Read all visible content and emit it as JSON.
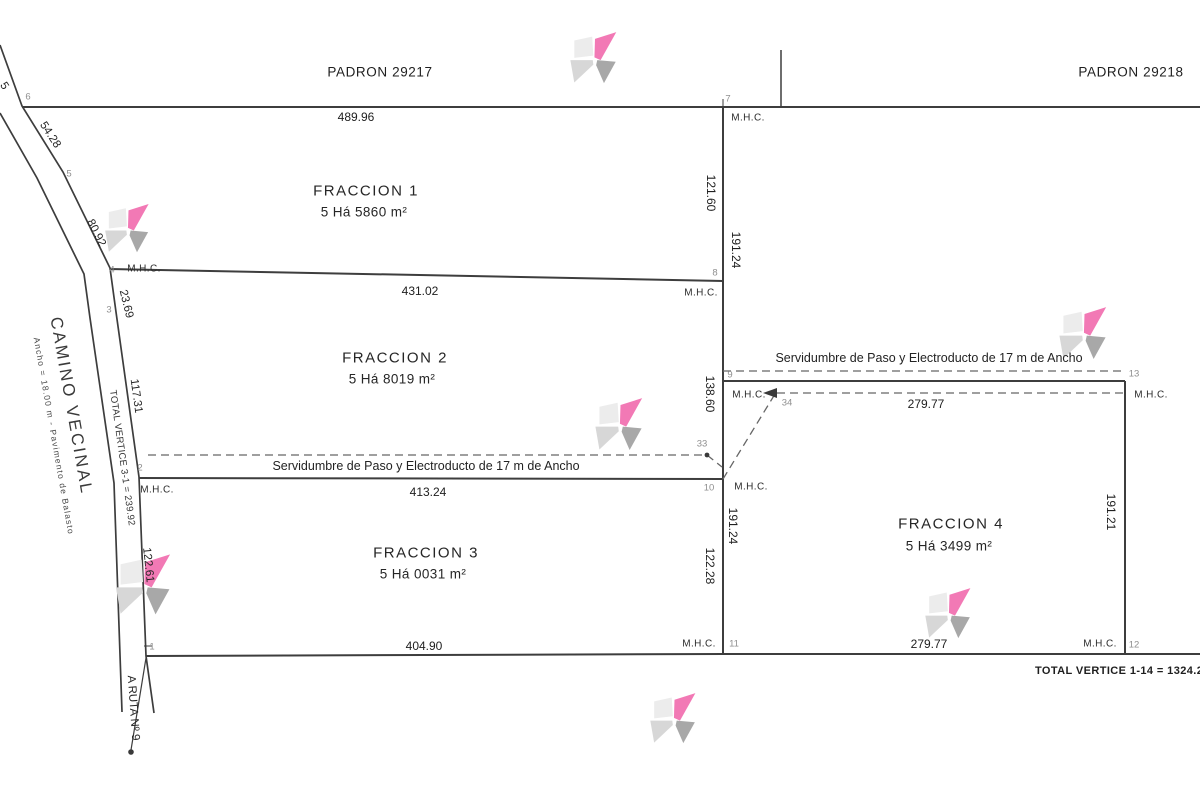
{
  "canvas": {
    "width": 1200,
    "height": 790,
    "background": "#ffffff"
  },
  "colors": {
    "line": "#3d3d3d",
    "dashed_line": "#666666",
    "text": "#232323",
    "vertex_text": "#8f8f8f"
  },
  "watermark_colors": {
    "pink": "#f279b5",
    "gray_light": "#ececec",
    "gray_mid": "#d7d7d7",
    "gray_dark": "#a8a8a8"
  },
  "watermarks": [
    {
      "x": 567,
      "y": 31,
      "size": 56
    },
    {
      "x": 102,
      "y": 203,
      "size": 53
    },
    {
      "x": 1056,
      "y": 306,
      "size": 57
    },
    {
      "x": 592,
      "y": 397,
      "size": 57
    },
    {
      "x": 112,
      "y": 553,
      "size": 66
    },
    {
      "x": 922,
      "y": 587,
      "size": 55
    },
    {
      "x": 647,
      "y": 692,
      "size": 55
    }
  ],
  "labels": [
    {
      "id": "padron-left-label",
      "text": "PADRON 29217",
      "x": 380,
      "y": 72,
      "cls": "padron"
    },
    {
      "id": "padron-right-label",
      "text": "PADRON 29218",
      "x": 1131,
      "y": 72,
      "cls": "padron"
    },
    {
      "id": "dim-6-7",
      "text": "489.96",
      "x": 356,
      "y": 117,
      "cls": "dim"
    },
    {
      "id": "vertex-7",
      "text": "7",
      "x": 728,
      "y": 99,
      "cls": "vertex"
    },
    {
      "id": "mhc-v7",
      "text": "M.H.C.",
      "x": 748,
      "y": 118,
      "cls": "mhc"
    },
    {
      "id": "dim-121-60",
      "text": "121.60",
      "x": 711,
      "y": 193,
      "rot": 90,
      "cls": "dim"
    },
    {
      "id": "dim-191-24-top",
      "text": "191.24",
      "x": 736,
      "y": 250,
      "rot": 90,
      "cls": "dim"
    },
    {
      "id": "fraccion1-name",
      "text": "FRACCION 1",
      "x": 366,
      "y": 191,
      "cls": "frac"
    },
    {
      "id": "fraccion1-area",
      "text": "5 Há 5860 m²",
      "x": 364,
      "y": 212,
      "cls": "area"
    },
    {
      "id": "vertex-4",
      "text": "4",
      "x": 112,
      "y": 270,
      "cls": "vertex"
    },
    {
      "id": "mhc-v4",
      "text": "M.H.C.",
      "x": 144,
      "y": 269,
      "cls": "mhc"
    },
    {
      "id": "vertex-8",
      "text": "8",
      "x": 715,
      "y": 273,
      "cls": "vertex"
    },
    {
      "id": "dim-4-8",
      "text": "431.02",
      "x": 420,
      "y": 291,
      "cls": "dim"
    },
    {
      "id": "mhc-v8",
      "text": "M.H.C.",
      "x": 701,
      "y": 293,
      "cls": "mhc"
    },
    {
      "id": "fraccion2-name",
      "text": "FRACCION 2",
      "x": 395,
      "y": 358,
      "cls": "frac"
    },
    {
      "id": "fraccion2-area",
      "text": "5 Há 8019 m²",
      "x": 392,
      "y": 379,
      "cls": "area"
    },
    {
      "id": "servidumbre-right",
      "text": "Servidumbre de Paso y Electroducto de 17 m de Ancho",
      "x": 929,
      "y": 358,
      "cls": "serv"
    },
    {
      "id": "dim-138-60",
      "text": "138.60",
      "x": 710,
      "y": 394,
      "rot": 90,
      "cls": "dim"
    },
    {
      "id": "vertex-9",
      "text": "9",
      "x": 730,
      "y": 375,
      "cls": "vertex"
    },
    {
      "id": "mhc-v9",
      "text": "M.H.C.",
      "x": 749,
      "y": 395,
      "cls": "mhc"
    },
    {
      "id": "vertex-34",
      "text": "34",
      "x": 787,
      "y": 403,
      "cls": "vertex"
    },
    {
      "id": "dim-34-13",
      "text": "279.77",
      "x": 926,
      "y": 404,
      "cls": "dim"
    },
    {
      "id": "vertex-13",
      "text": "13",
      "x": 1134,
      "y": 374,
      "cls": "vertex"
    },
    {
      "id": "mhc-v13",
      "text": "M.H.C.",
      "x": 1151,
      "y": 395,
      "cls": "mhc"
    },
    {
      "id": "vertex-33",
      "text": "33",
      "x": 702,
      "y": 444,
      "cls": "vertex"
    },
    {
      "id": "servidumbre-left",
      "text": "Servidumbre de Paso y Electroducto de 17 m de Ancho",
      "x": 426,
      "y": 466,
      "cls": "serv"
    },
    {
      "id": "vertex-2",
      "text": "2",
      "x": 140,
      "y": 468,
      "cls": "vertex"
    },
    {
      "id": "mhc-v2",
      "text": "M.H.C.",
      "x": 157,
      "y": 490,
      "cls": "mhc"
    },
    {
      "id": "dim-2-10",
      "text": "413.24",
      "x": 428,
      "y": 492,
      "cls": "dim"
    },
    {
      "id": "vertex-10",
      "text": "10",
      "x": 709,
      "y": 488,
      "cls": "vertex"
    },
    {
      "id": "mhc-v10",
      "text": "M.H.C.",
      "x": 751,
      "y": 487,
      "cls": "mhc"
    },
    {
      "id": "dim-191-24-bot",
      "text": "191.24",
      "x": 733,
      "y": 526,
      "rot": 90,
      "cls": "dim"
    },
    {
      "id": "dim-122-28",
      "text": "122.28",
      "x": 710,
      "y": 566,
      "rot": 90,
      "cls": "dim"
    },
    {
      "id": "fraccion3-name",
      "text": "FRACCION 3",
      "x": 426,
      "y": 553,
      "cls": "frac"
    },
    {
      "id": "fraccion3-area",
      "text": "5 Há 0031 m²",
      "x": 423,
      "y": 574,
      "cls": "area"
    },
    {
      "id": "fraccion4-name",
      "text": "FRACCION 4",
      "x": 951,
      "y": 524,
      "cls": "frac"
    },
    {
      "id": "fraccion4-area",
      "text": "5 Há 3499 m²",
      "x": 949,
      "y": 546,
      "cls": "area"
    },
    {
      "id": "dim-191-21",
      "text": "191.21",
      "x": 1111,
      "y": 512,
      "rot": 90,
      "cls": "dim"
    },
    {
      "id": "dim-1-11",
      "text": "404.90",
      "x": 424,
      "y": 646,
      "cls": "dim"
    },
    {
      "id": "mhc-v11",
      "text": "M.H.C.",
      "x": 699,
      "y": 644,
      "cls": "mhc"
    },
    {
      "id": "vertex-11",
      "text": "11",
      "x": 734,
      "y": 644,
      "cls": "vertex"
    },
    {
      "id": "dim-11-12",
      "text": "279.77",
      "x": 929,
      "y": 644,
      "cls": "dim"
    },
    {
      "id": "mhc-v12",
      "text": "M.H.C.",
      "x": 1100,
      "y": 644,
      "cls": "mhc"
    },
    {
      "id": "vertex-12",
      "text": "12",
      "x": 1134,
      "y": 645,
      "cls": "vertex"
    },
    {
      "id": "total-vertice-1-14",
      "text": "TOTAL VERTICE 1-14 = 1324.2",
      "x": 1035,
      "y": 671,
      "anchor": "left",
      "cls": "total-bold"
    },
    {
      "id": "camino-vecinal-label",
      "text": "CAMINO VECINAL",
      "x": 71,
      "y": 406,
      "rot": 80,
      "cls": "camino"
    },
    {
      "id": "camino-vecinal-sub",
      "text": "Ancho = 18.00 m - Pavimento de Balasto",
      "x": 54,
      "y": 436,
      "rot": 80,
      "cls": "camino-sub"
    },
    {
      "id": "dim-6-5",
      "text": "54.28",
      "x": 50,
      "y": 135,
      "rot": 57,
      "cls": "rdim"
    },
    {
      "id": "dim-5-4",
      "text": "80.92",
      "x": 96,
      "y": 233,
      "rot": 63,
      "cls": "rdim"
    },
    {
      "id": "dim-4-3",
      "text": "23.69",
      "x": 126,
      "y": 304,
      "rot": 76,
      "cls": "rdim"
    },
    {
      "id": "dim-3-2",
      "text": "117.31",
      "x": 136,
      "y": 396,
      "rot": 82,
      "cls": "rdim"
    },
    {
      "id": "total-vertice-3-1",
      "text": "TOTAL VERTICE 3-1 = 239.92",
      "x": 122,
      "y": 458,
      "rot": 82,
      "cls": "total-road"
    },
    {
      "id": "dim-2-1",
      "text": "122.61",
      "x": 148,
      "y": 565,
      "rot": 84,
      "cls": "rdim"
    },
    {
      "id": "ruta-label",
      "text": "A RUTA Nº 9",
      "x": 133,
      "y": 708,
      "rot": 86,
      "cls": "rdim"
    },
    {
      "id": "vertex-6",
      "text": "6",
      "x": 28,
      "y": 97,
      "cls": "vertex"
    },
    {
      "id": "vertex-5",
      "text": "5",
      "x": 69,
      "y": 174,
      "cls": "vertex"
    },
    {
      "id": "vertex-3",
      "text": "3",
      "x": 109,
      "y": 310,
      "cls": "vertex"
    },
    {
      "id": "vertex-1",
      "text": "1",
      "x": 152,
      "y": 647,
      "cls": "vertex"
    },
    {
      "id": "edge-cut-dim-fragment",
      "text": "5",
      "x": 4,
      "y": 86,
      "rot": 57,
      "cls": "rdim"
    }
  ]
}
